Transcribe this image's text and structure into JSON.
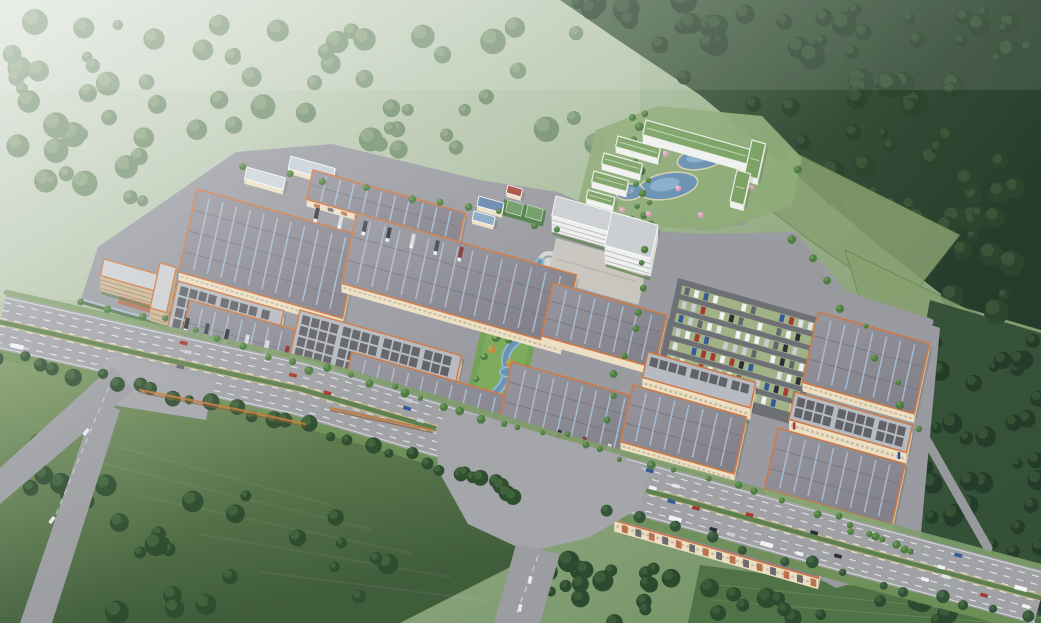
{
  "meta": {
    "description": "Aerial architectural rendering of a large industrial logistics park: rows of gray-roofed warehouses with orange trim and cream walls, a central landscaped strip with a winding blue stream, a white office building with plaza, a resort hotel with green roofs and lagoon pools in the wooded hills at top right, a car parking lot, loading trucks at docks, and a multi-lane highway with traffic crossing the foreground, surrounded by hazy green hills, farm fields and dark forest."
  },
  "palette": {
    "base_top": "#ccd7ca",
    "base_mid": "#9db38e",
    "base_low": "#6d8d5e",
    "mountain_a": "#4a6748",
    "mountain_b": "#253c2b",
    "hill_tree": "#5f7f58",
    "hill_tree_hi": "#7d9a6f",
    "field_a": "#7d9a64",
    "field_b": "#3f5c3b",
    "field_tree": "#2f4e30",
    "field_tree_hi": "#476b41",
    "campus_ground": "#999ba1",
    "road_light": "#a4a6aa",
    "road_mid": "#9b9da1",
    "roof_gray_a": "#98979f",
    "roof_gray_b": "#82818a",
    "roof_light": "#b7bac0",
    "panel_dark": "#595b62",
    "stripe_blue": "#adc3da",
    "trim_orange": "#cd7a46",
    "wall_cream": "#ecdfc3",
    "wall_shade": "#d6c6a8",
    "white_bld": "#eef0ed",
    "white_shade": "#d9dbd6",
    "tan_wall": "#cdb795",
    "tan_shade": "#b9a07d",
    "courtyard": "#b5705a",
    "green_roof": "#7ca265",
    "water": "#6a92b3",
    "water_light": "#9fc0da",
    "hedge": "#4f7044",
    "tree_green": "#4e7a44",
    "tree_bright": "#69a050",
    "tree_orange": "#c98a46",
    "lane_white": "#e9ebee",
    "median_green": "#5e804e",
    "fence_blue": "#a9c3d2",
    "parking_asphalt": "#6e7076",
    "parking_grass": "#a6b989",
    "plaza": "#c9c6c0",
    "court_green": "#4f7d4a",
    "court_inner": "#6f9a64",
    "logo_blue": "#2e4fa0",
    "logo_red": "#b03038"
  },
  "projection": {
    "u": [
      0.962,
      0.272
    ],
    "v": [
      -0.215,
      0.977
    ]
  },
  "background": {
    "mountain_poly": [
      [
        560,
        0
      ],
      [
        1041,
        0
      ],
      [
        1041,
        330
      ],
      [
        955,
        305
      ],
      [
        872,
        240
      ],
      [
        788,
        168
      ],
      [
        700,
        95
      ],
      [
        618,
        40
      ]
    ],
    "mountain_blob_count": 80,
    "hill_region": [
      [
        0,
        20
      ],
      [
        610,
        20
      ],
      [
        610,
        150
      ],
      [
        470,
        160
      ],
      [
        330,
        140
      ],
      [
        230,
        150
      ],
      [
        95,
        245
      ],
      [
        0,
        245
      ]
    ],
    "hill_blob_count": 70,
    "field_poly": [
      [
        0,
        350
      ],
      [
        200,
        396
      ],
      [
        380,
        445
      ],
      [
        470,
        468
      ],
      [
        528,
        492
      ],
      [
        520,
        562
      ],
      [
        400,
        623
      ],
      [
        0,
        623
      ]
    ],
    "field_tree_count": 30,
    "right_field_polys": [
      [
        [
          790,
          150
        ],
        [
          960,
          235
        ],
        [
          905,
          305
        ],
        [
          812,
          242
        ],
        [
          752,
          196
        ]
      ],
      [
        [
          845,
          250
        ],
        [
          990,
          320
        ],
        [
          950,
          360
        ],
        [
          860,
          300
        ]
      ]
    ],
    "right_forest_poly": [
      [
        930,
        300
      ],
      [
        1041,
        333
      ],
      [
        1041,
        623
      ],
      [
        884,
        572
      ],
      [
        906,
        430
      ]
    ],
    "right_forest_count": 46,
    "bottom_forest_poly": [
      [
        536,
        556
      ],
      [
        800,
        584
      ],
      [
        1041,
        612
      ],
      [
        1041,
        623
      ],
      [
        524,
        623
      ]
    ],
    "bottom_forest_count": 36,
    "lawn_poly": [
      [
        700,
        565
      ],
      [
        900,
        592
      ],
      [
        1041,
        616
      ],
      [
        1041,
        623
      ],
      [
        688,
        623
      ]
    ],
    "roadside_tree_line": [
      [
        0,
        356
      ],
      [
        150,
        390
      ],
      [
        300,
        424
      ],
      [
        450,
        468
      ],
      [
        518,
        496
      ]
    ],
    "roadside_tree_count": 32,
    "roadside_tree_line2": [
      [
        610,
        512
      ],
      [
        760,
        552
      ],
      [
        900,
        588
      ],
      [
        1030,
        618
      ]
    ],
    "roadside_tree_count2": 14
  },
  "campus": {
    "plate": [
      [
        80,
        302
      ],
      [
        98,
        247
      ],
      [
        236,
        152
      ],
      [
        332,
        144
      ],
      [
        480,
        180
      ],
      [
        558,
        192
      ],
      [
        642,
        230
      ],
      [
        700,
        234
      ],
      [
        795,
        232
      ],
      [
        852,
        298
      ],
      [
        940,
        328
      ],
      [
        918,
        565
      ],
      [
        836,
        588
      ],
      [
        600,
        452
      ],
      [
        452,
        406
      ],
      [
        295,
        360
      ],
      [
        158,
        324
      ]
    ],
    "perimeter": [
      [
        84,
        300
      ],
      [
        300,
        362
      ],
      [
        452,
        408
      ],
      [
        614,
        452
      ],
      [
        836,
        518
      ],
      [
        908,
        556
      ]
    ],
    "internal_roads": [
      {
        "pts": [
          [
            246,
            164
          ],
          [
            430,
            200
          ],
          [
            540,
            222
          ],
          [
            602,
            236
          ]
        ],
        "w": 7
      },
      {
        "pts": [
          [
            648,
            246
          ],
          [
            630,
            330
          ],
          [
            606,
            420
          ],
          [
            587,
            476
          ]
        ],
        "w": 10
      },
      {
        "pts": [
          [
            795,
            240
          ],
          [
            862,
            330
          ],
          [
            922,
            432
          ],
          [
            988,
            548
          ]
        ],
        "w": 9
      },
      {
        "pts": [
          [
            700,
            250
          ],
          [
            850,
            296
          ],
          [
            930,
            322
          ]
        ],
        "w": 7
      },
      {
        "pts": [
          [
            508,
            250
          ],
          [
            490,
            332
          ],
          [
            468,
            408
          ]
        ],
        "w": 7
      },
      {
        "pts": [
          [
            560,
            236
          ],
          [
            600,
            242
          ],
          [
            648,
            246
          ]
        ],
        "w": 6
      },
      {
        "pts": [
          [
            648,
            210
          ],
          [
            700,
            228
          ],
          [
            744,
            222
          ]
        ],
        "w": 5
      }
    ],
    "tree_count": 42
  },
  "buildings": [
    {
      "id": "shed-1",
      "x": 247,
      "y": 167,
      "l": 40,
      "w": 12,
      "kind": "plain",
      "roof": "#ccd5da",
      "wallH": 5
    },
    {
      "id": "shed-2",
      "x": 291,
      "y": 156,
      "l": 46,
      "w": 13,
      "kind": "plain",
      "roof": "#c6d0d8",
      "wallH": 5
    },
    {
      "id": "warehouse-top",
      "x": 313,
      "y": 170,
      "l": 158,
      "w": 30,
      "kind": "stripe",
      "wallH": 7,
      "docks": true
    },
    {
      "id": "warehouse-left-big",
      "x": 197,
      "y": 189,
      "l": 170,
      "w": 85,
      "kind": "stripe",
      "wallH": 9
    },
    {
      "id": "warehouse-center-big",
      "x": 357,
      "y": 213,
      "l": 228,
      "w": 72,
      "kind": "stripe",
      "wallH": 9
    },
    {
      "id": "factory-left",
      "x": 178,
      "y": 281,
      "l": 110,
      "w": 50,
      "kind": "panel",
      "wallH": 13,
      "logo": true
    },
    {
      "id": "factory-center",
      "x": 300,
      "y": 310,
      "l": 168,
      "w": 58,
      "kind": "panel",
      "wallH": 13,
      "logo": true
    },
    {
      "id": "dorm-a",
      "x": 104,
      "y": 259,
      "l": 74,
      "w": 17,
      "kind": "tan",
      "wallH": 15
    },
    {
      "id": "dorm-b",
      "x": 160,
      "y": 263,
      "l": 17,
      "w": 46,
      "kind": "tan",
      "wallH": 13
    },
    {
      "id": "warehouse-front-left",
      "x": 190,
      "y": 300,
      "l": 152,
      "w": 68,
      "kind": "stripe",
      "wallH": 10,
      "docks": true
    },
    {
      "id": "warehouse-front-center",
      "x": 352,
      "y": 352,
      "l": 225,
      "w": 66,
      "kind": "stripe",
      "wallH": 10,
      "docks": true,
      "logo": true
    },
    {
      "id": "warehouse-mid-right-1",
      "x": 553,
      "y": 283,
      "l": 118,
      "w": 54,
      "kind": "stripe",
      "wallH": 8
    },
    {
      "id": "warehouse-mid-right-2",
      "x": 512,
      "y": 362,
      "l": 148,
      "w": 60,
      "kind": "stripe",
      "wallH": 9
    },
    {
      "id": "office-main",
      "x": 556,
      "y": 196,
      "l": 88,
      "w": 20,
      "kind": "white",
      "wallH": 16
    },
    {
      "id": "office-tower",
      "x": 612,
      "y": 212,
      "l": 48,
      "w": 34,
      "kind": "white",
      "wallH": 18
    },
    {
      "id": "utility-1",
      "x": 479,
      "y": 196,
      "l": 26,
      "w": 10,
      "kind": "plain",
      "roof": "#6888b0",
      "wallH": 5
    },
    {
      "id": "utility-2",
      "x": 474,
      "y": 211,
      "l": 22,
      "w": 9,
      "kind": "plain",
      "roof": "#88a8c4",
      "wallH": 4
    },
    {
      "id": "utility-3",
      "x": 508,
      "y": 185,
      "l": 15,
      "w": 8,
      "kind": "plain",
      "roof": "#a84e42",
      "wallH": 4
    },
    {
      "id": "factory-east",
      "x": 648,
      "y": 352,
      "l": 112,
      "w": 26,
      "kind": "panel",
      "wallH": 12
    },
    {
      "id": "warehouse-east-1",
      "x": 633,
      "y": 385,
      "l": 118,
      "w": 58,
      "kind": "stripe",
      "wallH": 9
    },
    {
      "id": "warehouse-right-big",
      "x": 818,
      "y": 312,
      "l": 116,
      "w": 72,
      "kind": "stripe",
      "wallH": 9
    },
    {
      "id": "factory-right",
      "x": 795,
      "y": 392,
      "l": 122,
      "w": 28,
      "kind": "panel",
      "wallH": 12,
      "logo": true
    },
    {
      "id": "warehouse-right-2",
      "x": 778,
      "y": 428,
      "l": 132,
      "w": 62,
      "kind": "stripe",
      "wallH": 9
    },
    {
      "id": "warehouse-front-east",
      "x": 628,
      "y": 458,
      "l": 212,
      "w": 64,
      "kind": "stripe",
      "wallH": 11,
      "docks": true
    },
    {
      "id": "gate-house",
      "x": 437,
      "y": 415,
      "l": 32,
      "w": 12,
      "kind": "plain",
      "roof": "#e8e9e6",
      "wallH": 6,
      "sign": true
    },
    {
      "id": "hotel-main",
      "x": 646,
      "y": 120,
      "l": 108,
      "w": 15,
      "kind": "green",
      "wallH": 8
    },
    {
      "id": "hotel-wing-1",
      "x": 618,
      "y": 136,
      "l": 44,
      "w": 11,
      "kind": "green",
      "wallH": 6
    },
    {
      "id": "hotel-wing-2",
      "x": 604,
      "y": 153,
      "l": 40,
      "w": 11,
      "kind": "green",
      "wallH": 6
    },
    {
      "id": "hotel-wing-3",
      "x": 594,
      "y": 171,
      "l": 36,
      "w": 11,
      "kind": "green",
      "wallH": 6
    },
    {
      "id": "hotel-east-1",
      "x": 752,
      "y": 140,
      "l": 14,
      "w": 36,
      "kind": "green",
      "wallH": 6
    },
    {
      "id": "hotel-east-2",
      "x": 737,
      "y": 170,
      "l": 14,
      "w": 32,
      "kind": "green",
      "wallH": 6
    },
    {
      "id": "hotel-wing-4",
      "x": 588,
      "y": 190,
      "l": 28,
      "w": 9,
      "kind": "green",
      "wallH": 5
    }
  ],
  "extras": {
    "courtyard": {
      "x": 122,
      "y": 284,
      "l": 40,
      "w": 20
    },
    "plaza": {
      "x": 556,
      "y": 238,
      "l": 95,
      "w": 42
    },
    "courts": {
      "x": 504,
      "y": 199,
      "l": 44,
      "w": 16
    },
    "ribbons": [
      [
        [
          140,
          390
        ],
        [
          200,
          402
        ],
        [
          250,
          412
        ],
        [
          305,
          424
        ]
      ],
      [
        [
          330,
          408
        ],
        [
          382,
          419
        ],
        [
          432,
          430
        ]
      ]
    ]
  },
  "river": {
    "strip": {
      "x": 498,
      "y": 252,
      "l": 56,
      "w": 180
    },
    "path": "M540,262 C520,288 550,298 536,320 C522,342 502,344 506,366 C510,388 488,394 482,412 C476,430 470,434 464,430",
    "plaza": {
      "cx": 549,
      "cy": 263,
      "r": 12
    },
    "ponds": [
      [
        528,
        302,
        9,
        5
      ],
      [
        486,
        404,
        11,
        6
      ],
      [
        508,
        372,
        8,
        5
      ]
    ],
    "tree_count": 16
  },
  "resort": {
    "lawn": [
      [
        578,
        202
      ],
      [
        596,
        130
      ],
      [
        658,
        106
      ],
      [
        762,
        116
      ],
      [
        802,
        158
      ],
      [
        792,
        206
      ],
      [
        720,
        230
      ],
      [
        640,
        226
      ]
    ],
    "pools": [
      [
        668,
        186,
        30,
        13,
        -10
      ],
      [
        702,
        158,
        25,
        11,
        -12
      ],
      [
        630,
        192,
        14,
        8,
        -8
      ]
    ],
    "blossom_count": 7,
    "tree_count": 18
  },
  "parking": {
    "x": 678,
    "y": 278,
    "l": 150,
    "w": 110,
    "rows": 7,
    "slots": 14
  },
  "trucks": [
    {
      "a": [
        318,
        208
      ],
      "b": [
        462,
        247
      ],
      "n": 7
    },
    {
      "a": [
        225,
        345
      ],
      "b": [
        405,
        393
      ],
      "n": 8
    },
    {
      "a": [
        652,
        478
      ],
      "b": [
        822,
        524
      ],
      "n": 9
    },
    {
      "a": [
        188,
        318
      ],
      "b": [
        288,
        346
      ],
      "n": 6
    },
    {
      "a": [
        560,
        430
      ],
      "b": [
        610,
        444
      ],
      "n": 3
    }
  ],
  "truck_colors": [
    "#d8d8dc",
    "#34373d",
    "#8a3434",
    "#c8c9cd",
    "#3f4a58"
  ],
  "highway": {
    "center": [
      [
        0,
        322
      ],
      [
        150,
        356
      ],
      [
        300,
        389
      ],
      [
        455,
        435
      ],
      [
        560,
        467
      ],
      [
        700,
        505
      ],
      [
        850,
        547
      ],
      [
        1041,
        598
      ]
    ],
    "halfwidth": 27,
    "lanes": [
      -20,
      -12,
      -4,
      4,
      12,
      20
    ],
    "median_segments": [
      [
        [
          0,
          322
        ],
        [
          150,
          356
        ],
        [
          300,
          389
        ],
        [
          448,
          432
        ]
      ],
      [
        [
          648,
          491
        ],
        [
          700,
          505
        ],
        [
          850,
          547
        ],
        [
          1041,
          598
        ]
      ]
    ],
    "car_count": 30,
    "intersection": [
      [
        450,
        408
      ],
      [
        565,
        440
      ],
      [
        618,
        454
      ],
      [
        648,
        472
      ],
      [
        640,
        508
      ],
      [
        588,
        538
      ],
      [
        528,
        552
      ],
      [
        468,
        524
      ],
      [
        438,
        470
      ],
      [
        436,
        428
      ]
    ],
    "left_plaza": [
      [
        110,
        354
      ],
      [
        214,
        380
      ],
      [
        206,
        420
      ],
      [
        118,
        406
      ],
      [
        98,
        386
      ]
    ],
    "branch_down": [
      [
        516,
        544
      ],
      [
        560,
        554
      ],
      [
        540,
        623
      ],
      [
        494,
        623
      ]
    ],
    "left_road_a": [
      [
        0,
        468
      ],
      [
        112,
        366
      ],
      [
        134,
        390
      ],
      [
        0,
        504
      ]
    ],
    "left_road_b": [
      [
        96,
        400
      ],
      [
        120,
        410
      ],
      [
        52,
        623
      ],
      [
        20,
        623
      ]
    ]
  },
  "car_colors": [
    "#f0f1f3",
    "#2b2f34",
    "#a83832",
    "#c8ccd2",
    "#5f666e",
    "#37599c",
    "#e0e2e6",
    "#f0f1f3"
  ]
}
